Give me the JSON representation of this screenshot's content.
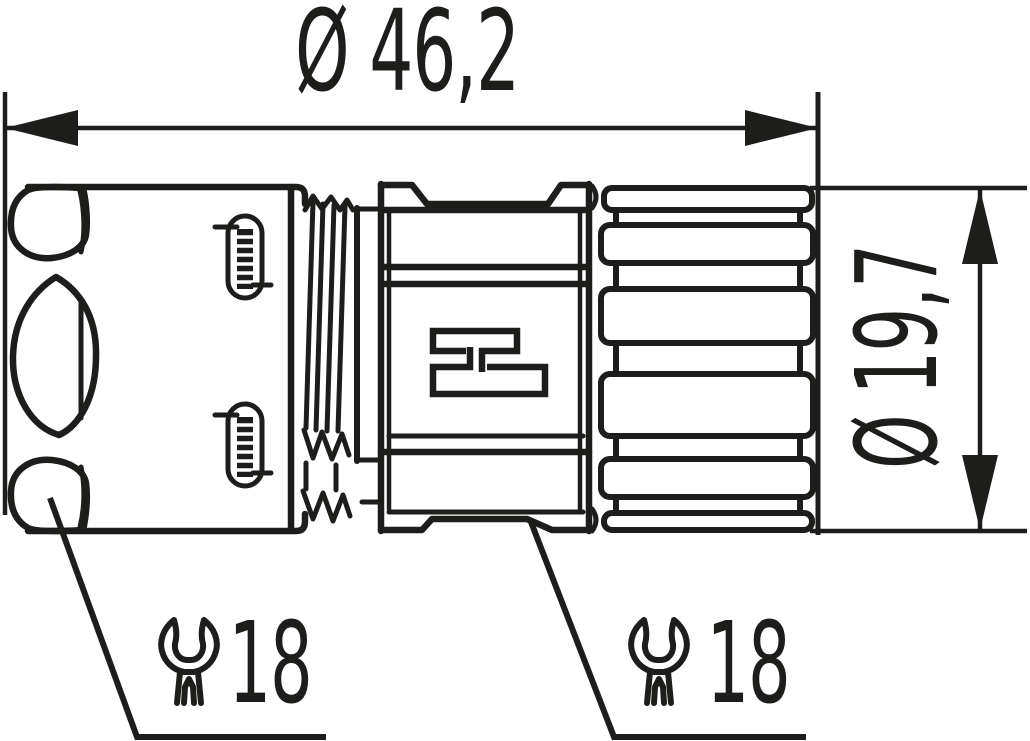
{
  "drawing": {
    "colors": {
      "line": "#1d1d1b",
      "background": "#ffffff"
    },
    "dimensions": {
      "overall_length": {
        "label": "Ø 46,2"
      },
      "front_diameter": {
        "label": "Ø 19,7"
      }
    },
    "annotations": {
      "wrench_left": {
        "icon": "open-end-wrench-icon",
        "label": "18"
      },
      "wrench_right": {
        "icon": "open-end-wrench-icon",
        "label": "18"
      }
    }
  }
}
